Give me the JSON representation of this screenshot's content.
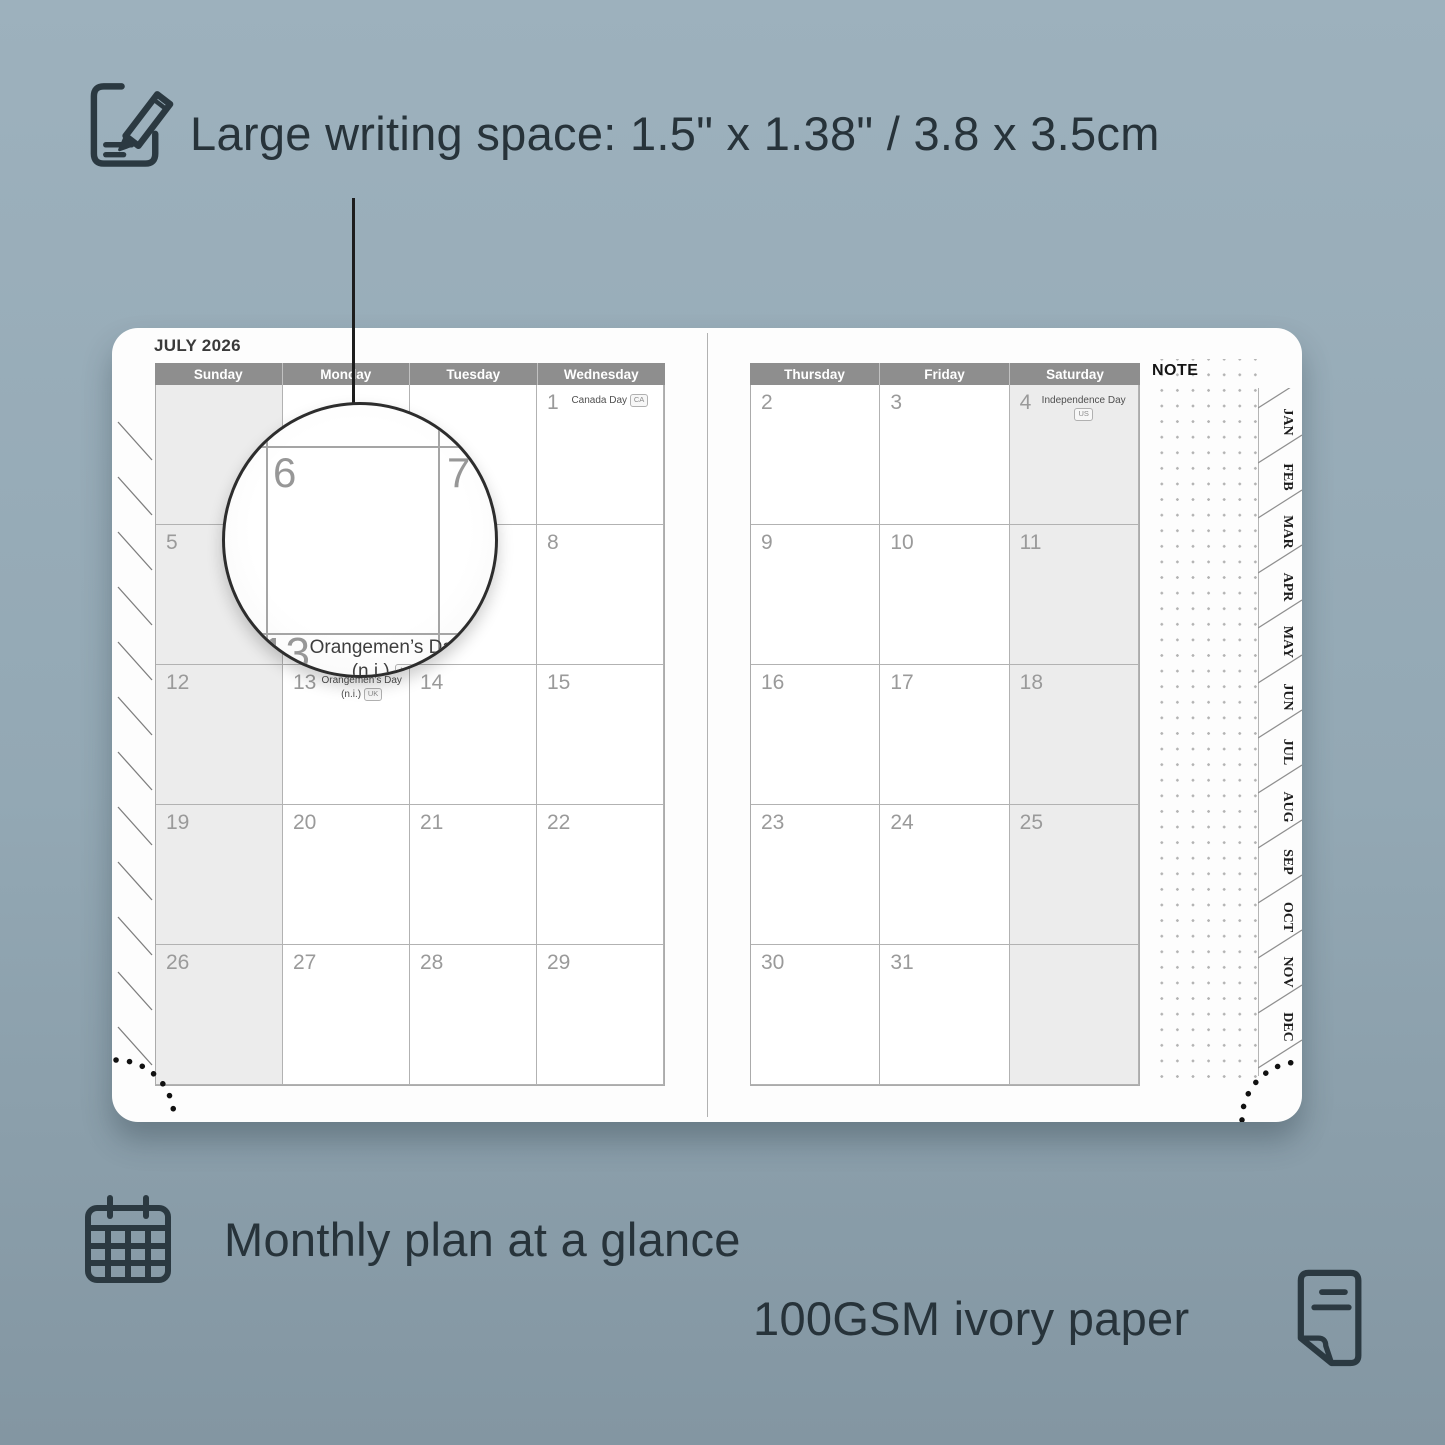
{
  "annotations": {
    "top": {
      "icon": "pencil-note-icon",
      "text": "Large writing space: 1.5\" x 1.38\" / 3.8 x 3.5cm"
    },
    "bottom_left": {
      "icon": "calendar-grid-icon",
      "text": "Monthly plan at a glance"
    },
    "bottom_right": {
      "icon": "paper-sheet-icon",
      "text": "100GSM ivory paper"
    }
  },
  "planner": {
    "month_title": "JULY 2026",
    "note_label": "NOTE",
    "left_page": {
      "day_headers": [
        "Sunday",
        "Monday",
        "Tuesday",
        "Wednesday"
      ],
      "weeks": [
        [
          {
            "d": "",
            "shaded": true
          },
          {
            "d": ""
          },
          {
            "d": ""
          },
          {
            "d": "1",
            "holiday": "Canada Day",
            "badge": "CA"
          }
        ],
        [
          {
            "d": "5",
            "shaded": true
          },
          {
            "d": "6"
          },
          {
            "d": "7"
          },
          {
            "d": "8"
          }
        ],
        [
          {
            "d": "12",
            "shaded": true
          },
          {
            "d": "13",
            "holiday": "Orangemen’s Day (n.i.)",
            "badge": "UK"
          },
          {
            "d": "14"
          },
          {
            "d": "15"
          }
        ],
        [
          {
            "d": "19",
            "shaded": true
          },
          {
            "d": "20"
          },
          {
            "d": "21"
          },
          {
            "d": "22"
          }
        ],
        [
          {
            "d": "26",
            "shaded": true
          },
          {
            "d": "27"
          },
          {
            "d": "28"
          },
          {
            "d": "29"
          }
        ]
      ]
    },
    "right_page": {
      "day_headers": [
        "Thursday",
        "Friday",
        "Saturday"
      ],
      "weeks": [
        [
          {
            "d": "2"
          },
          {
            "d": "3"
          },
          {
            "d": "4",
            "holiday": "Independence Day",
            "badge": "US",
            "shaded": true
          }
        ],
        [
          {
            "d": "9"
          },
          {
            "d": "10"
          },
          {
            "d": "11",
            "shaded": true
          }
        ],
        [
          {
            "d": "16"
          },
          {
            "d": "17"
          },
          {
            "d": "18",
            "shaded": true
          }
        ],
        [
          {
            "d": "23"
          },
          {
            "d": "24"
          },
          {
            "d": "25",
            "shaded": true
          }
        ],
        [
          {
            "d": "30"
          },
          {
            "d": "31"
          },
          {
            "d": "",
            "shaded": true
          }
        ]
      ]
    },
    "month_tabs": [
      "JAN",
      "FEB",
      "MAR",
      "APR",
      "MAY",
      "JUN",
      "JUL",
      "AUG",
      "SEP",
      "OCT",
      "NOV",
      "DEC"
    ],
    "magnifier": {
      "day_large": "6",
      "day_right": "7",
      "day_below": "13",
      "holiday_line1": "Orangemen’s Day",
      "holiday_line2": "(n.i.)",
      "badge": "UK"
    }
  },
  "colors": {
    "background": "#95aab6",
    "ink": "#27333a",
    "header_bar": "#8e8e8e",
    "shaded_cell": "#ececec",
    "page": "#fdfdfd"
  }
}
